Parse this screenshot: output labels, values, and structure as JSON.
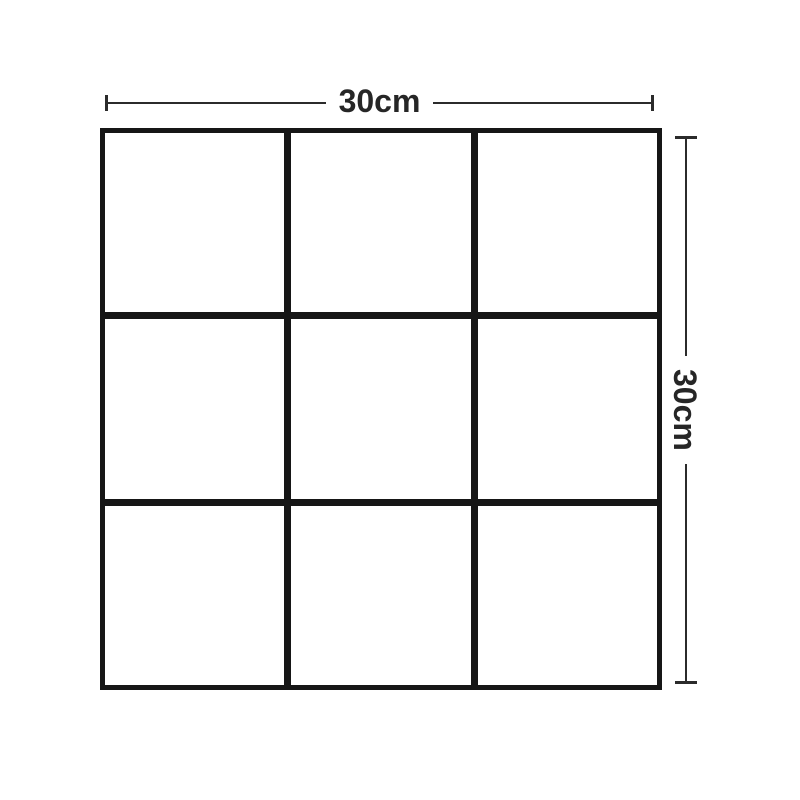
{
  "diagram": {
    "type": "product-dimension-diagram",
    "grid": {
      "rows": 3,
      "cols": 3,
      "line_color": "#161616",
      "cell_color": "#ffffff"
    },
    "annotations": {
      "width": {
        "label": "30cm",
        "orientation": "horizontal"
      },
      "height": {
        "label": "30cm",
        "orientation": "vertical"
      },
      "line_color": "#2b2b2b",
      "text_color": "#262626"
    },
    "background_color": "#ffffff"
  }
}
